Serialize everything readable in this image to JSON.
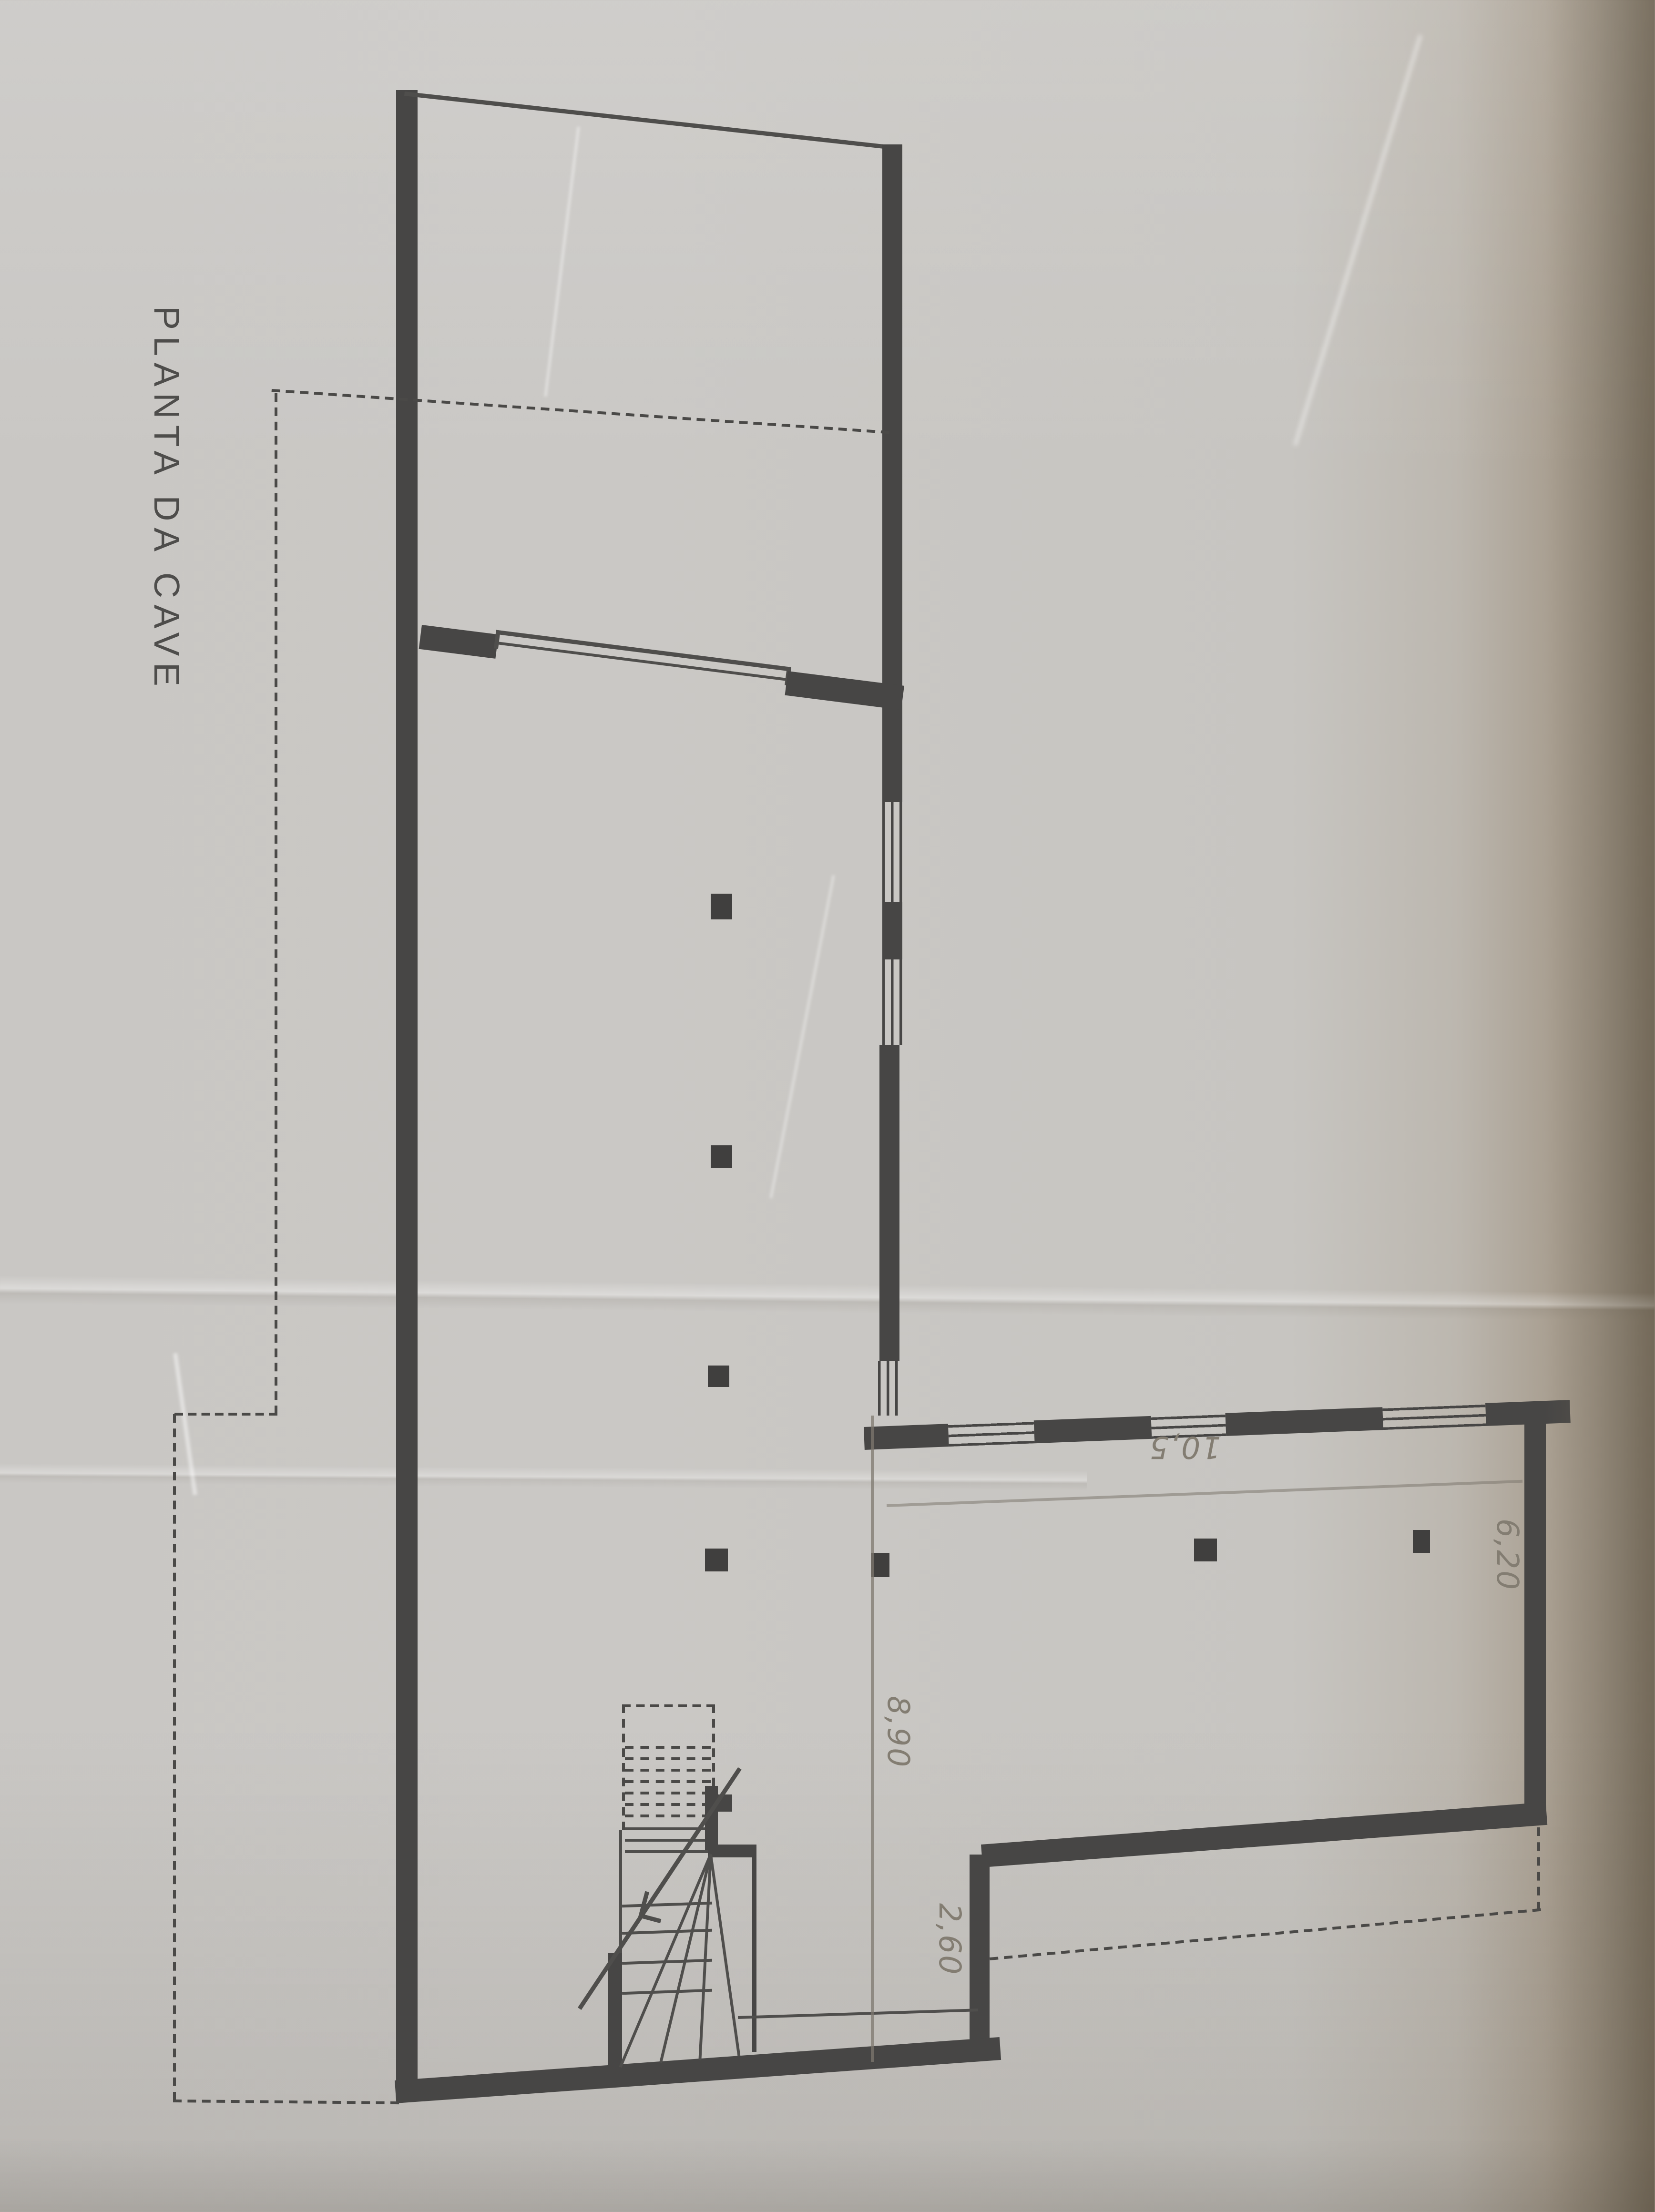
{
  "document": {
    "title": "PLANTA DA CAVE",
    "type_label": "floor-plan-scan"
  },
  "annotations": {
    "dim_building_width": "8,90",
    "dim_recess": "2,60",
    "dim_wing_length": "10,5",
    "dim_wing_width": "6,20"
  },
  "colors": {
    "ink": "#474645",
    "pencil": "#837d72",
    "paper": "#c9c7c4",
    "photo_shadow": "#847a6b"
  }
}
